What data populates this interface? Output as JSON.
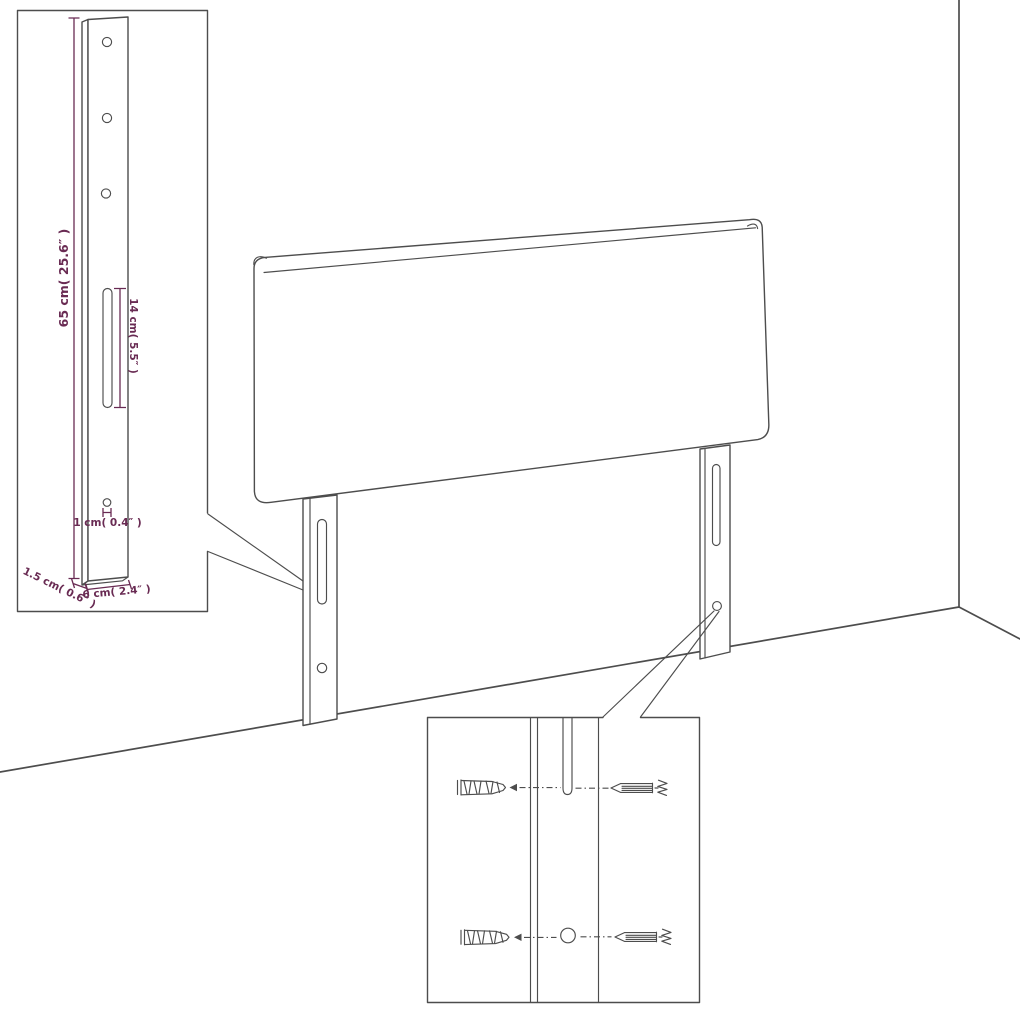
{
  "diagram": {
    "kind": "furniture-assembly-dimension-diagram",
    "subject": "headboard-with-mounting-legs",
    "colors": {
      "outline": "#4d4d4d",
      "dimension": "#692b53",
      "background": "#ffffff"
    },
    "dimensions": {
      "leg_height": "65 cm( 25.6″ )",
      "slot_length": "14 cm( 5.5″ )",
      "hole_diameter": "1 cm( 0.4″ )",
      "leg_depth": "1.5 cm( 0.6″ )",
      "leg_width": "6 cm( 2.4″ )"
    },
    "insets": {
      "leg_detail": {
        "parts": [
          "mounting-leg",
          "screw-holes",
          "mounting-slot"
        ]
      },
      "hardware_detail": {
        "parts": [
          "wall-plug",
          "screw",
          "mounting-slot",
          "mounting-hole"
        ]
      }
    }
  }
}
